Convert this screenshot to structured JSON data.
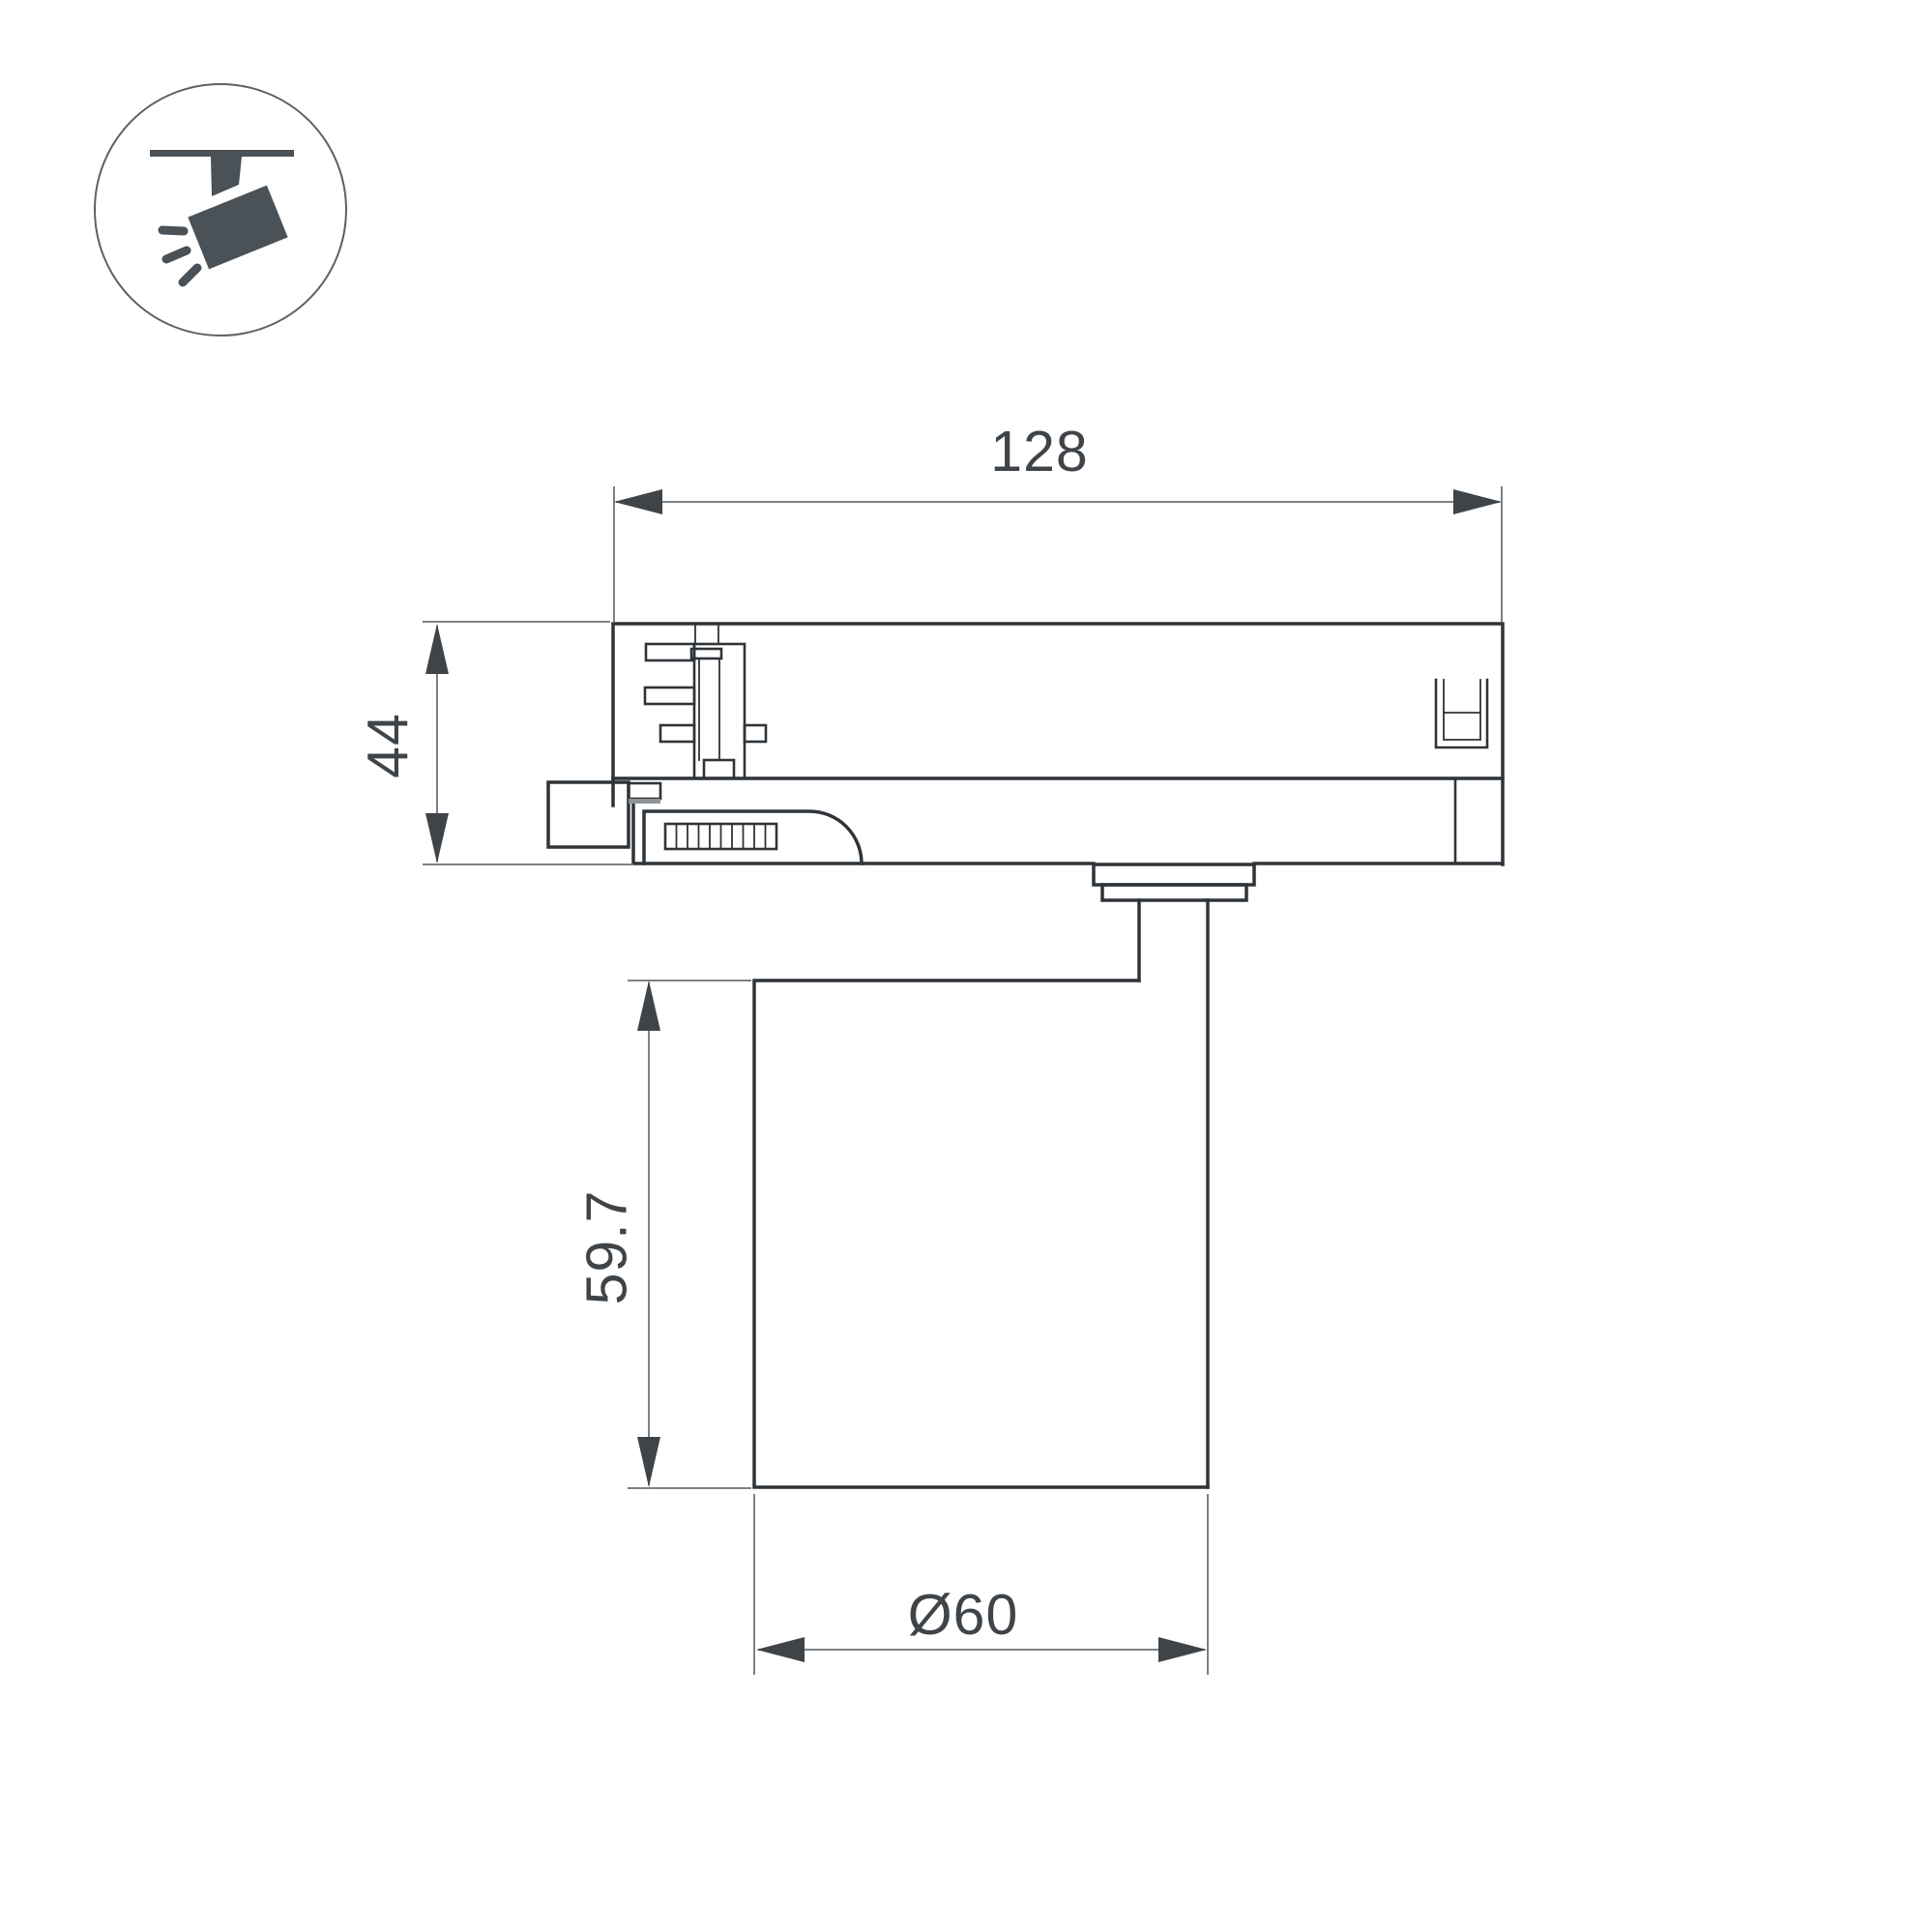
{
  "drawing": {
    "kind": "track-spotlight dimension drawing",
    "dimensions": {
      "overall_width": "128",
      "adapter_height": "44",
      "head_height": "59.7",
      "head_diameter": "Ø60"
    }
  },
  "icon": {
    "name": "ceiling-track-spotlight"
  },
  "colors": {
    "background": "#ffffff",
    "outline": "#2f3439",
    "dimension_line": "#7d8185",
    "dimension_text": "#3f4449",
    "icon_fill": "#4a5157",
    "icon_circle_stroke": "#5c6165"
  }
}
